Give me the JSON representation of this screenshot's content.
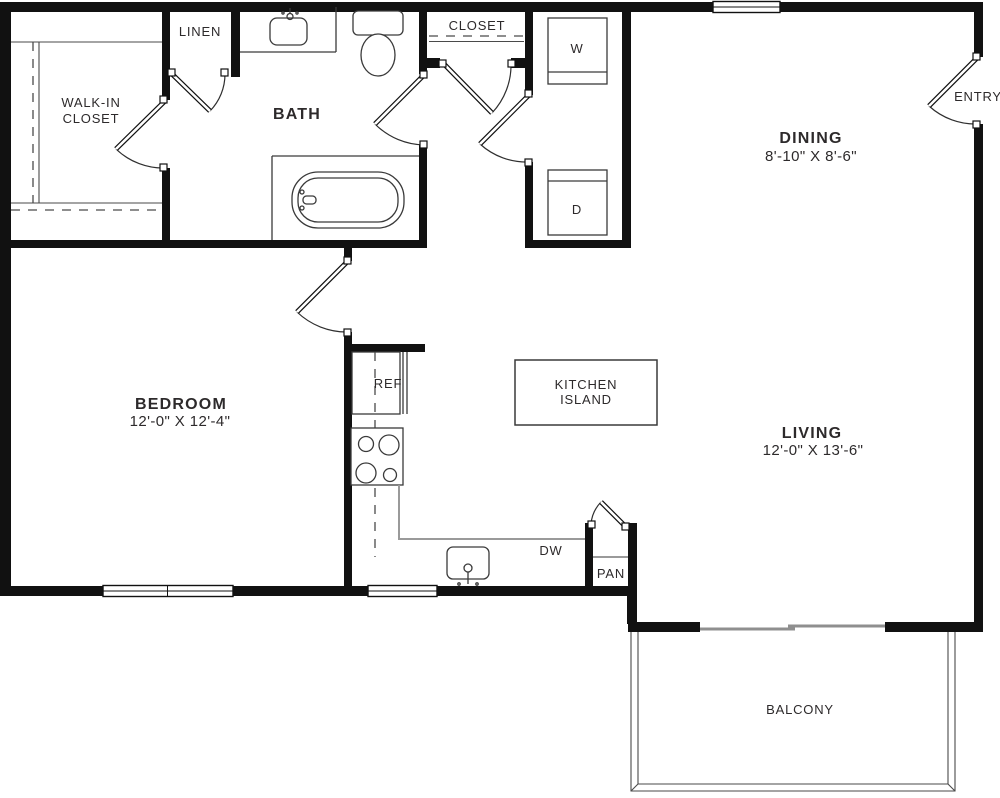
{
  "plan": {
    "rooms": {
      "walk_in_closet": {
        "label_line1": "WALK-IN",
        "label_line2": "CLOSET"
      },
      "linen": {
        "label": "LINEN"
      },
      "bath": {
        "label": "BATH"
      },
      "hall_closet": {
        "label": "CLOSET"
      },
      "dining": {
        "label": "DINING",
        "dimensions": "8'-10\" X 8'-6\""
      },
      "entry": {
        "label": "ENTRY"
      },
      "bedroom": {
        "label": "BEDROOM",
        "dimensions": "12'-0\" X 12'-4\""
      },
      "living": {
        "label": "LIVING",
        "dimensions": "12'-0\" X 13'-6\""
      },
      "kitchen_island": {
        "label_line1": "KITCHEN",
        "label_line2": "ISLAND"
      },
      "pantry": {
        "label": "PAN"
      },
      "balcony": {
        "label": "BALCONY"
      }
    },
    "appliances": {
      "washer": "W",
      "dryer": "D",
      "refrigerator": "REF",
      "dishwasher": "DW"
    },
    "colors": {
      "wall": "#111111",
      "fixture_line": "#3a3a3a",
      "counter_line": "#9a9a9a",
      "text": "#2d2a2b",
      "background": "#ffffff"
    }
  }
}
